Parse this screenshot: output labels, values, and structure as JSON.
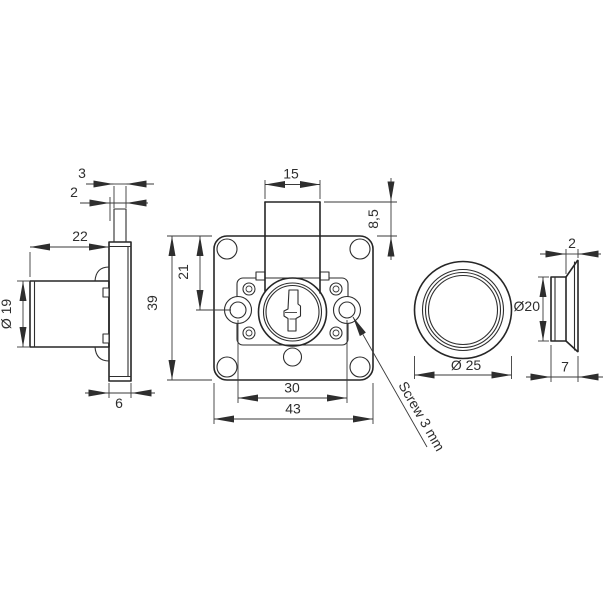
{
  "drawing": {
    "background": "#ffffff",
    "line_color": "#2e2e2e",
    "views": {
      "lock_side": {
        "dims": {
          "bolt_thickness": "3",
          "bolt_plate_offset": "2",
          "housing_length": "22",
          "housing_diameter": "Ø 19",
          "faceplate_thickness": "6"
        }
      },
      "lock_front": {
        "dims": {
          "bolt_width": "15",
          "bolt_extension": "8,5",
          "hole_center_offset": "21",
          "plate_height": "39",
          "hole_spacing": "30",
          "plate_width": "43"
        },
        "callout": "Screw 3 mm"
      },
      "rosette_front": {
        "dims": {
          "outer_diameter": "Ø 25"
        }
      },
      "rosette_side": {
        "dims": {
          "rim_width": "2",
          "bore_diameter": "Ø20",
          "depth": "7"
        }
      }
    }
  }
}
